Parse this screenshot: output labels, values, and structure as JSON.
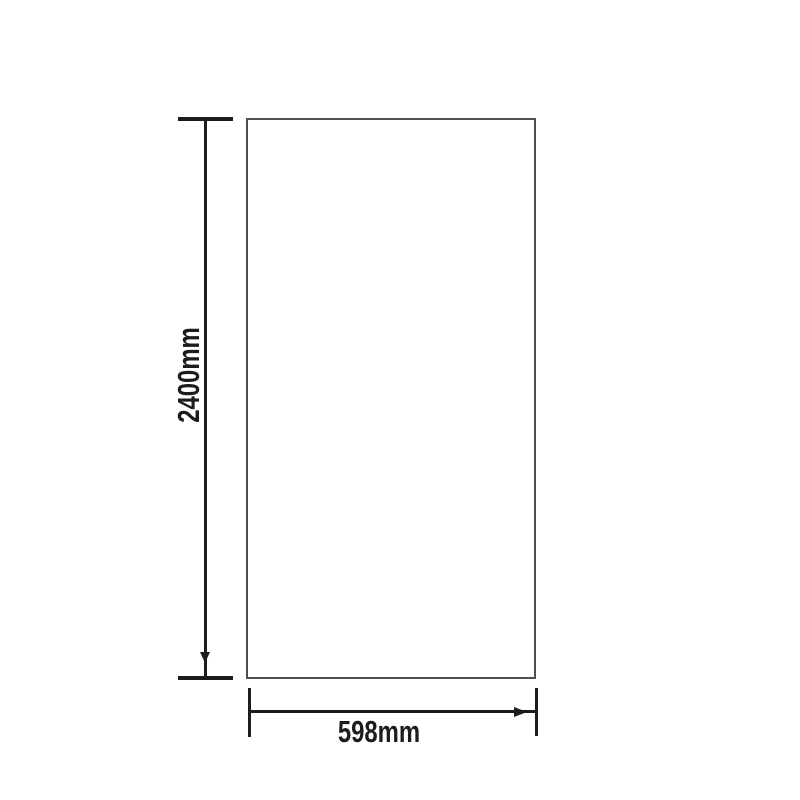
{
  "canvas": {
    "background_color": "#ffffff",
    "width_px": 800,
    "height_px": 800
  },
  "diagram": {
    "kind": "product-dimension-drawing",
    "colors": {
      "panel_outline": "#4f4f4f",
      "dimension_line": "#1c1c1c",
      "label_text": "#1c1c1c"
    }
  },
  "dimensions": {
    "height": {
      "label": "2400mm"
    },
    "width": {
      "label": "598mm"
    }
  },
  "icons": {
    "arrowhead_down": "solid triangle pointing down",
    "arrowhead_right": "solid triangle pointing right"
  }
}
